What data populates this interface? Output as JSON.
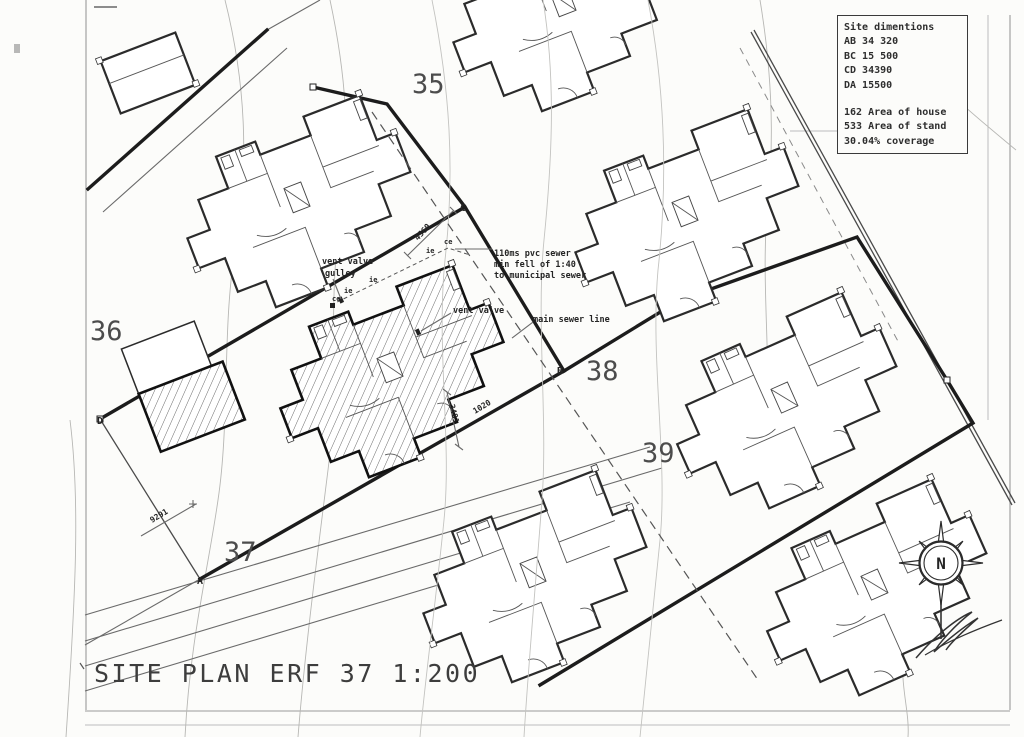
{
  "sheet": {
    "title": "SITE PLAN ERF 37 1:200"
  },
  "title_block": {
    "heading": "Site dimentions",
    "dim_lines": [
      "AB 34 320",
      "BC 15 500",
      "CD 34390",
      "DA 15500"
    ],
    "area_lines": [
      "162 Area of house",
      "533 Area of stand",
      "30.04% coverage"
    ]
  },
  "erf_labels": {
    "erf35": "35",
    "erf36": "36",
    "erf37": "37",
    "erf38": "38",
    "erf39": "39"
  },
  "corner_labels": {
    "a": "A",
    "b": "B",
    "c": "C",
    "d": "D"
  },
  "annotations": {
    "vent_valve_1": "vent valve",
    "gulley": "gulley",
    "vent_valve_2": "vent valve",
    "sewer_note_1": "110ms pvc sewer",
    "sewer_note_2": "min fell of 1:40",
    "sewer_note_3": "to municipal sewer",
    "main_sewer": "main sewer line",
    "ie": "ie",
    "ce": "ce"
  },
  "dimensions": {
    "dim_bc": "4560",
    "dim_ab": "1020",
    "dim_setback": "3481",
    "dim_da": "9291"
  },
  "compass": {
    "north_label": "N"
  },
  "colors": {
    "ink": "#2b2b2b",
    "light_line": "#b7b7b4",
    "paper": "#fcfcfa"
  }
}
